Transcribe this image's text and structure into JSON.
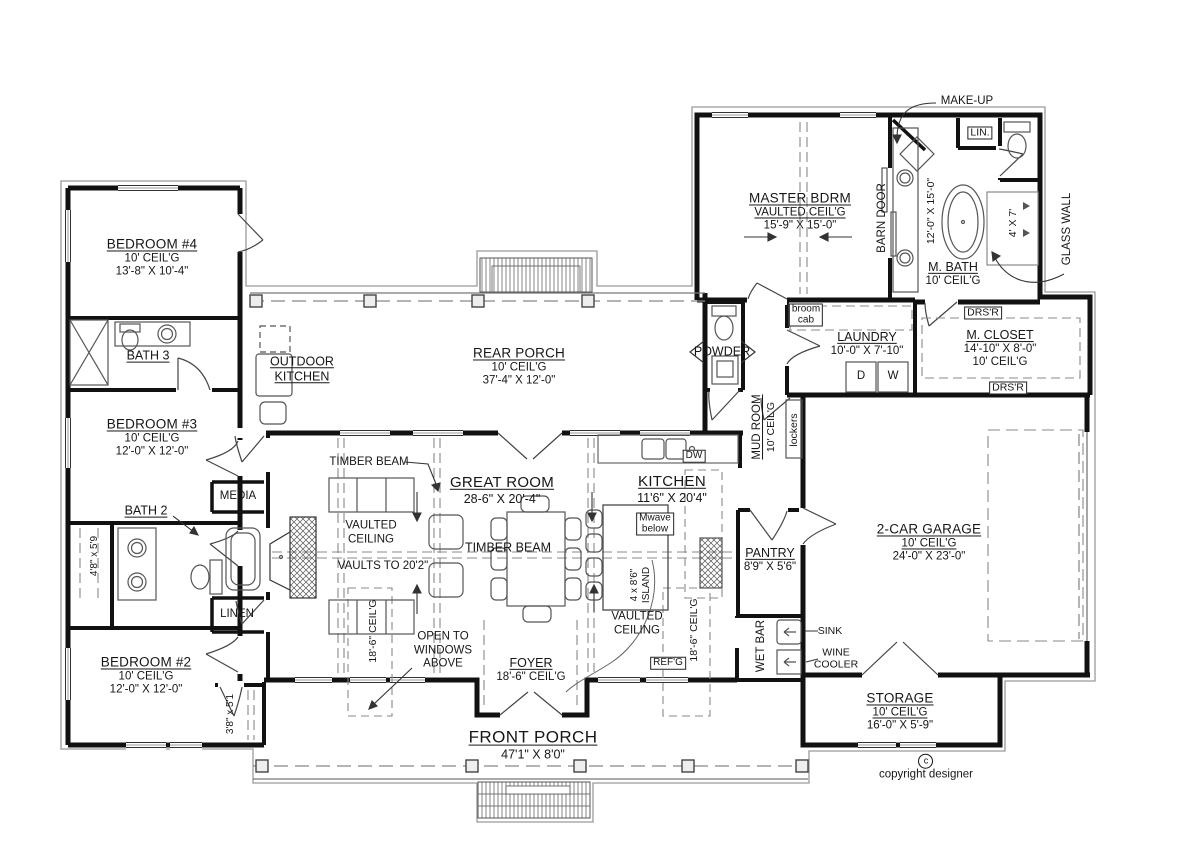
{
  "plan": {
    "rooms": {
      "bedroom4": {
        "name": "BEDROOM #4",
        "ceil": "10' CEIL'G",
        "dims": "13'-8\" X 10'-4\""
      },
      "bath3": {
        "name": "BATH 3"
      },
      "bedroom3": {
        "name": "BEDROOM #3",
        "ceil": "10' CEIL'G",
        "dims": "12'-0\" X 12'-0\""
      },
      "bath2": {
        "name": "BATH 2"
      },
      "bedroom2": {
        "name": "BEDROOM #2",
        "ceil": "10' CEIL'G",
        "dims": "12'-0\" X 12'-0\""
      },
      "media": {
        "name": "MEDIA"
      },
      "linen": {
        "name": "LINEN"
      },
      "outdoor_kitchen": {
        "line1": "OUTDOOR",
        "line2": "KITCHEN"
      },
      "rear_porch": {
        "name": "REAR PORCH",
        "ceil": "10' CEIL'G",
        "dims": "37'-4\" X 12'-0\""
      },
      "powder": {
        "name": "POWDER"
      },
      "master_bdrm": {
        "name": "MASTER BDRM",
        "ceil": "VAULTED CEIL'G",
        "dims": "15'-9\" X 15'-0\""
      },
      "m_bath": {
        "name": "M. BATH",
        "ceil": "10' CEIL'G",
        "dims": "12'-0\" X 15'-0\"",
        "shower": "4' X 7'"
      },
      "m_closet": {
        "name": "M. CLOSET",
        "dims": "14'-10\" X 8'-0\"",
        "ceil": "10' CEIL'G"
      },
      "laundry": {
        "name": "LAUNDRY",
        "dims": "10'-0\" X 7'-10\""
      },
      "mud_room": {
        "name": "MUD ROOM",
        "ceil": "10' CEIL'G"
      },
      "pantry": {
        "name": "PANTRY",
        "dims": "8'9\" X 5'6\""
      },
      "wet_bar": {
        "name": "WET BAR"
      },
      "great_room": {
        "name": "GREAT ROOM",
        "dims": "28-6\" X 20'-4\""
      },
      "kitchen": {
        "name": "KITCHEN",
        "dims": "11'6\" X 20'4\""
      },
      "foyer": {
        "name": "FOYER",
        "ceil": "18'-6\" CEIL'G"
      },
      "garage": {
        "name": "2-CAR GARAGE",
        "ceil": "10' CEIL'G",
        "dims": "24'-0\" X 23'-0\""
      },
      "storage": {
        "name": "STORAGE",
        "ceil": "10' CEIL'G",
        "dims": "16'-0\" X 5'-9\""
      },
      "front_porch": {
        "name": "FRONT PORCH",
        "dims": "47'1\" X 8'0\""
      }
    },
    "annotations": {
      "make_up": "MAKE-UP",
      "lin": "LIN.",
      "barn_door": "BARN DOOR",
      "glass_wall": "GLASS WALL",
      "broom_line1": "broom",
      "broom_line2": "cab",
      "drsr": "DRS'R",
      "dryer": "D",
      "washer": "W",
      "lockers": "lockers",
      "dw": "DW",
      "mwave_line1": "Mwave",
      "mwave_line2": "below",
      "island_line1": "4 x 8'6\"",
      "island_line2": "ISLAND",
      "timber_beam": "TIMBER BEAM",
      "vaulted_line1": "VAULTED",
      "vaulted_line2": "CEILING",
      "vaults_to": "VAULTS TO 20'2\"",
      "ceil_186": "18'-6\" CEIL'G",
      "open_line1": "OPEN TO",
      "open_line2": "WINDOWS",
      "open_line3": "ABOVE",
      "closet_a": "4'8\" x 5'9",
      "closet_b": "3'8\" x 5'1",
      "refg": "REF'G",
      "sink": "SINK",
      "wine_line1": "WINE",
      "wine_line2": "COOLER",
      "copyright_symbol": "c",
      "copyright": "copyright designer"
    }
  }
}
